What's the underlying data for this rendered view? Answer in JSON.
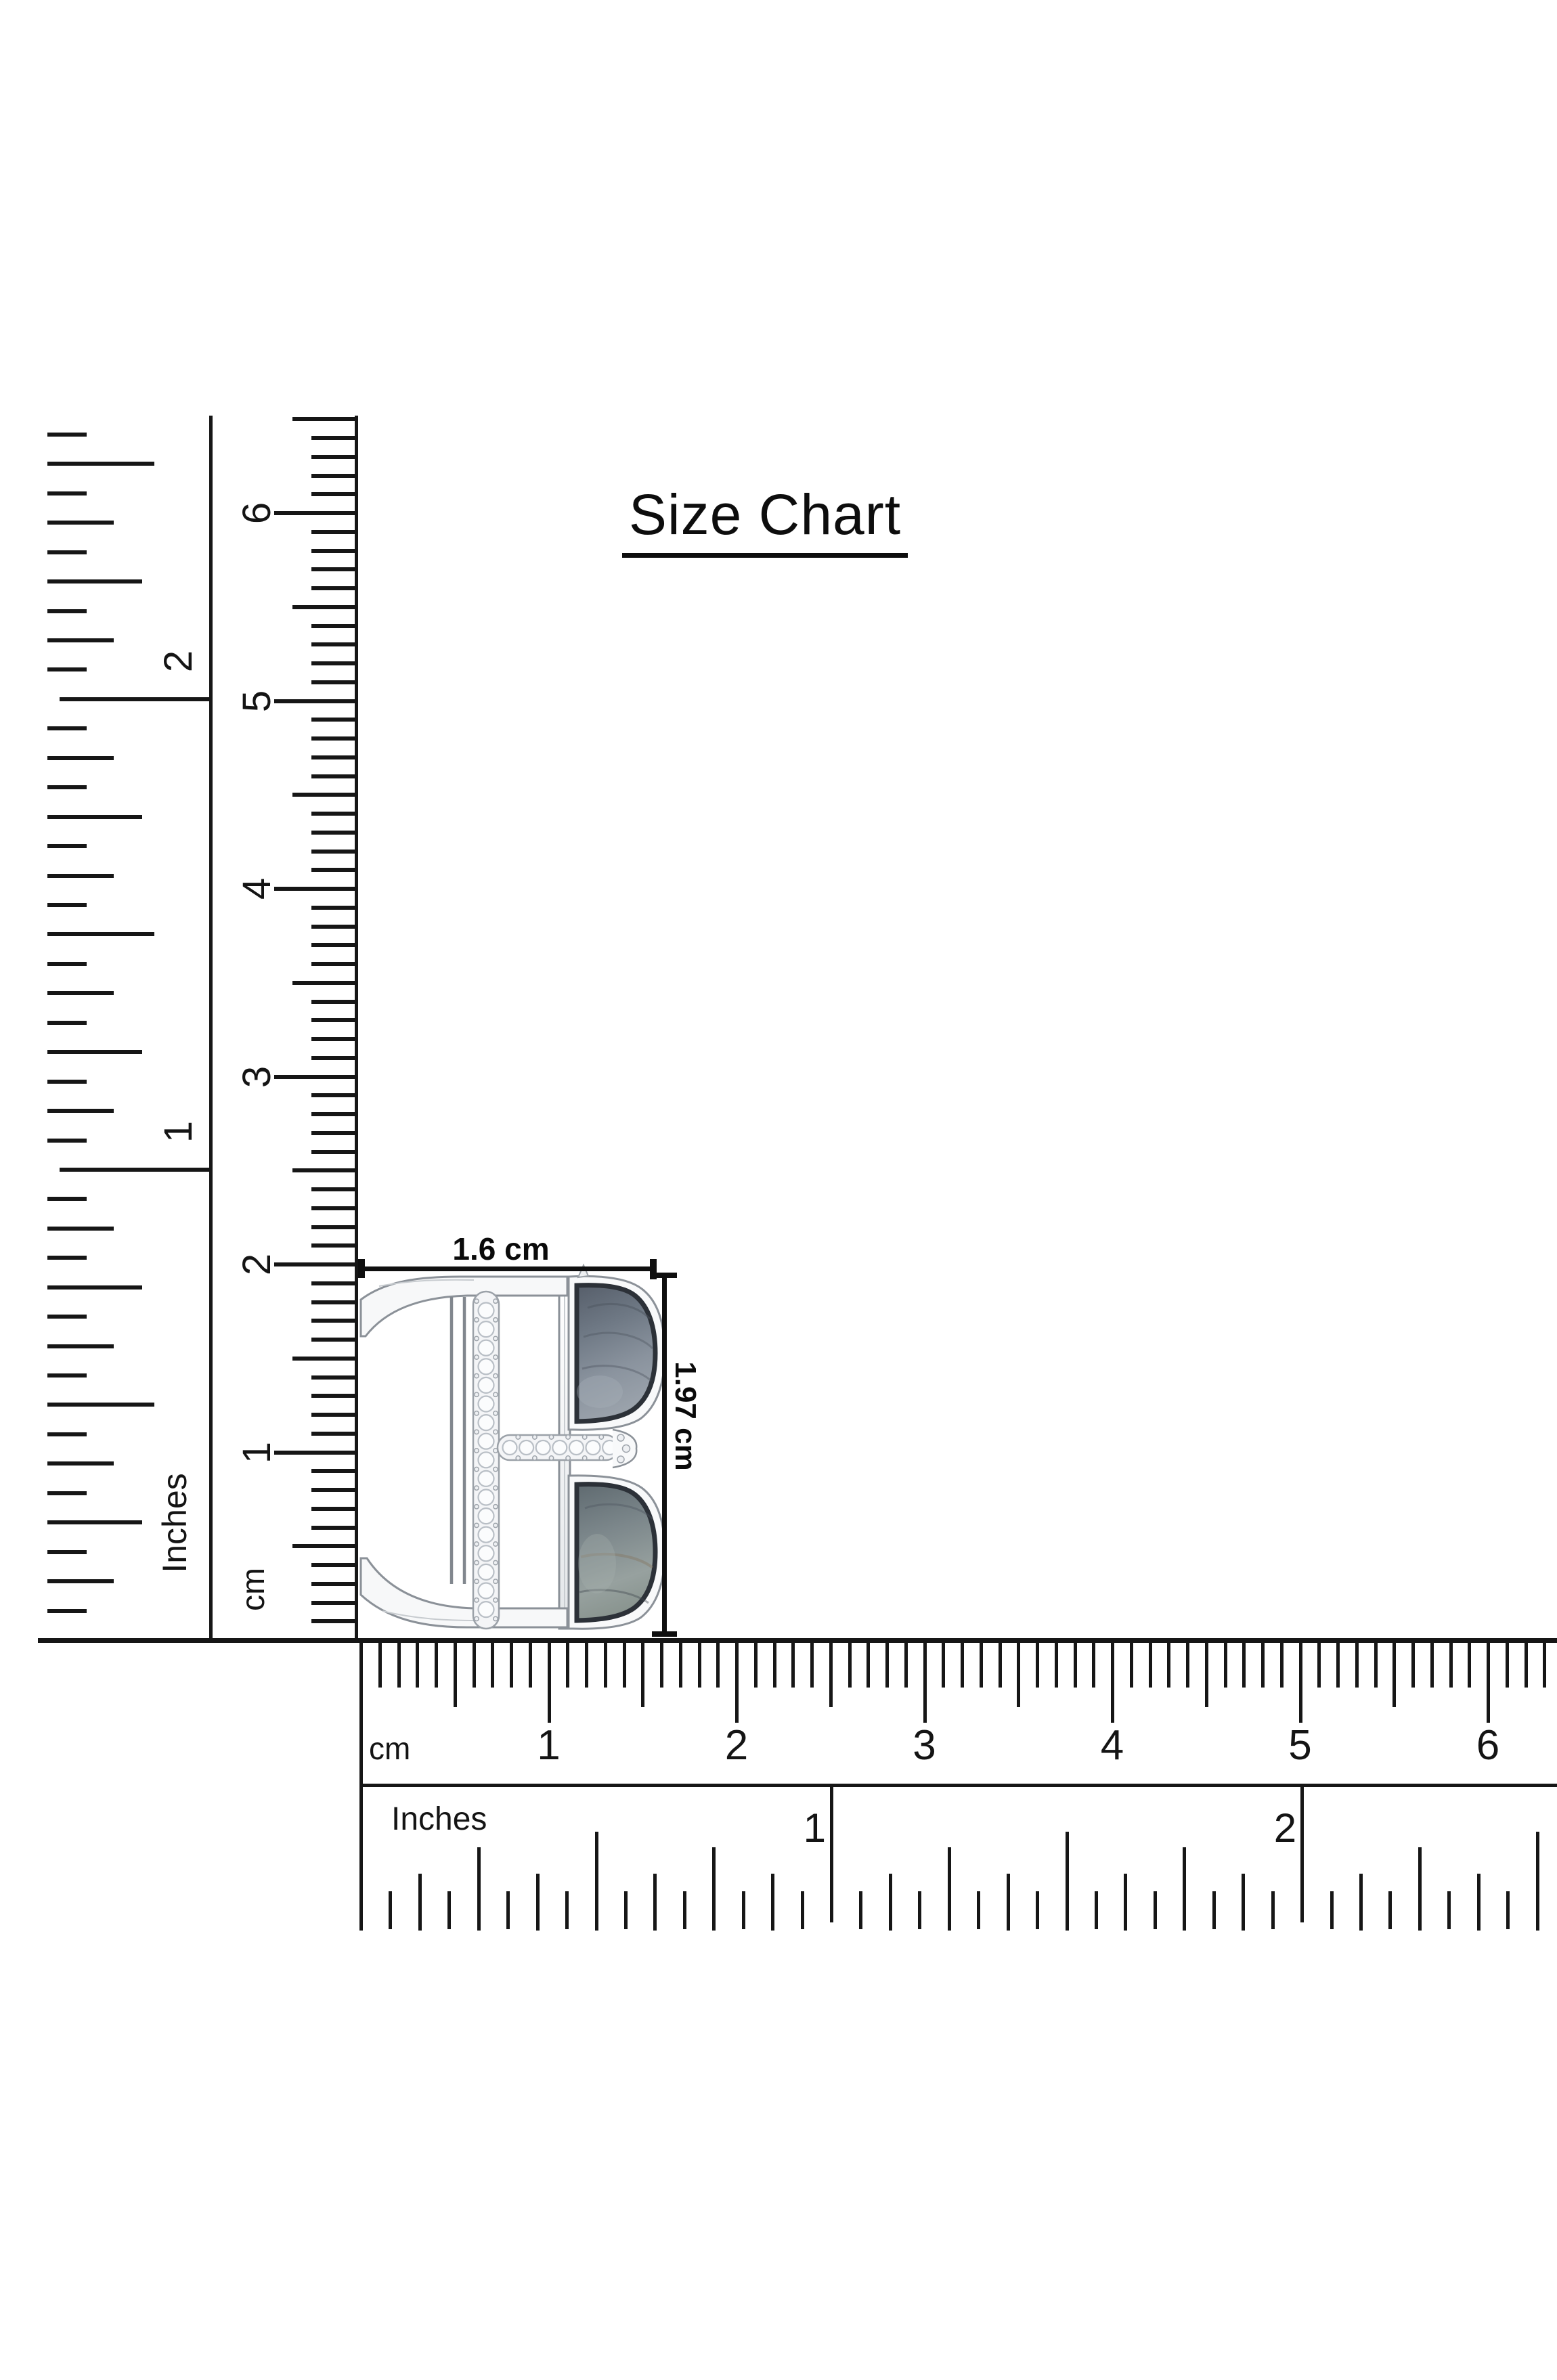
{
  "title": {
    "text": "Size Chart"
  },
  "dimensions": {
    "width_label": "1.6 cm",
    "height_label": "1.97 cm"
  },
  "rulers": {
    "vertical_inch": {
      "unit_label": "Inches",
      "tick_labels": [
        "1",
        "2"
      ]
    },
    "vertical_cm": {
      "unit_label": "cm",
      "tick_labels": [
        "1",
        "2",
        "3",
        "4",
        "5",
        "6"
      ]
    },
    "horizontal_cm": {
      "unit_label": "cm",
      "tick_labels": [
        "1",
        "2",
        "3",
        "4",
        "5",
        "6"
      ]
    },
    "horizontal_inch": {
      "unit_label": "Inches",
      "tick_labels": [
        "1",
        "2"
      ]
    }
  },
  "jewelry": {
    "kind": "letter-B-pendant-illustration",
    "materials": "silver frame, pave diamond bars, two labradorite half-moon gemstones"
  },
  "colors": {
    "line": "#161616",
    "text": "#111111",
    "metal_fill": "#f7f8f9",
    "metal_stroke": "#8b9198",
    "gem_dark": "#565e6a",
    "gem_mid": "#7b8591",
    "gem_light": "#9aa2ab",
    "gem_rim": "#2c3138",
    "gem_streak_brown": "#857763"
  }
}
